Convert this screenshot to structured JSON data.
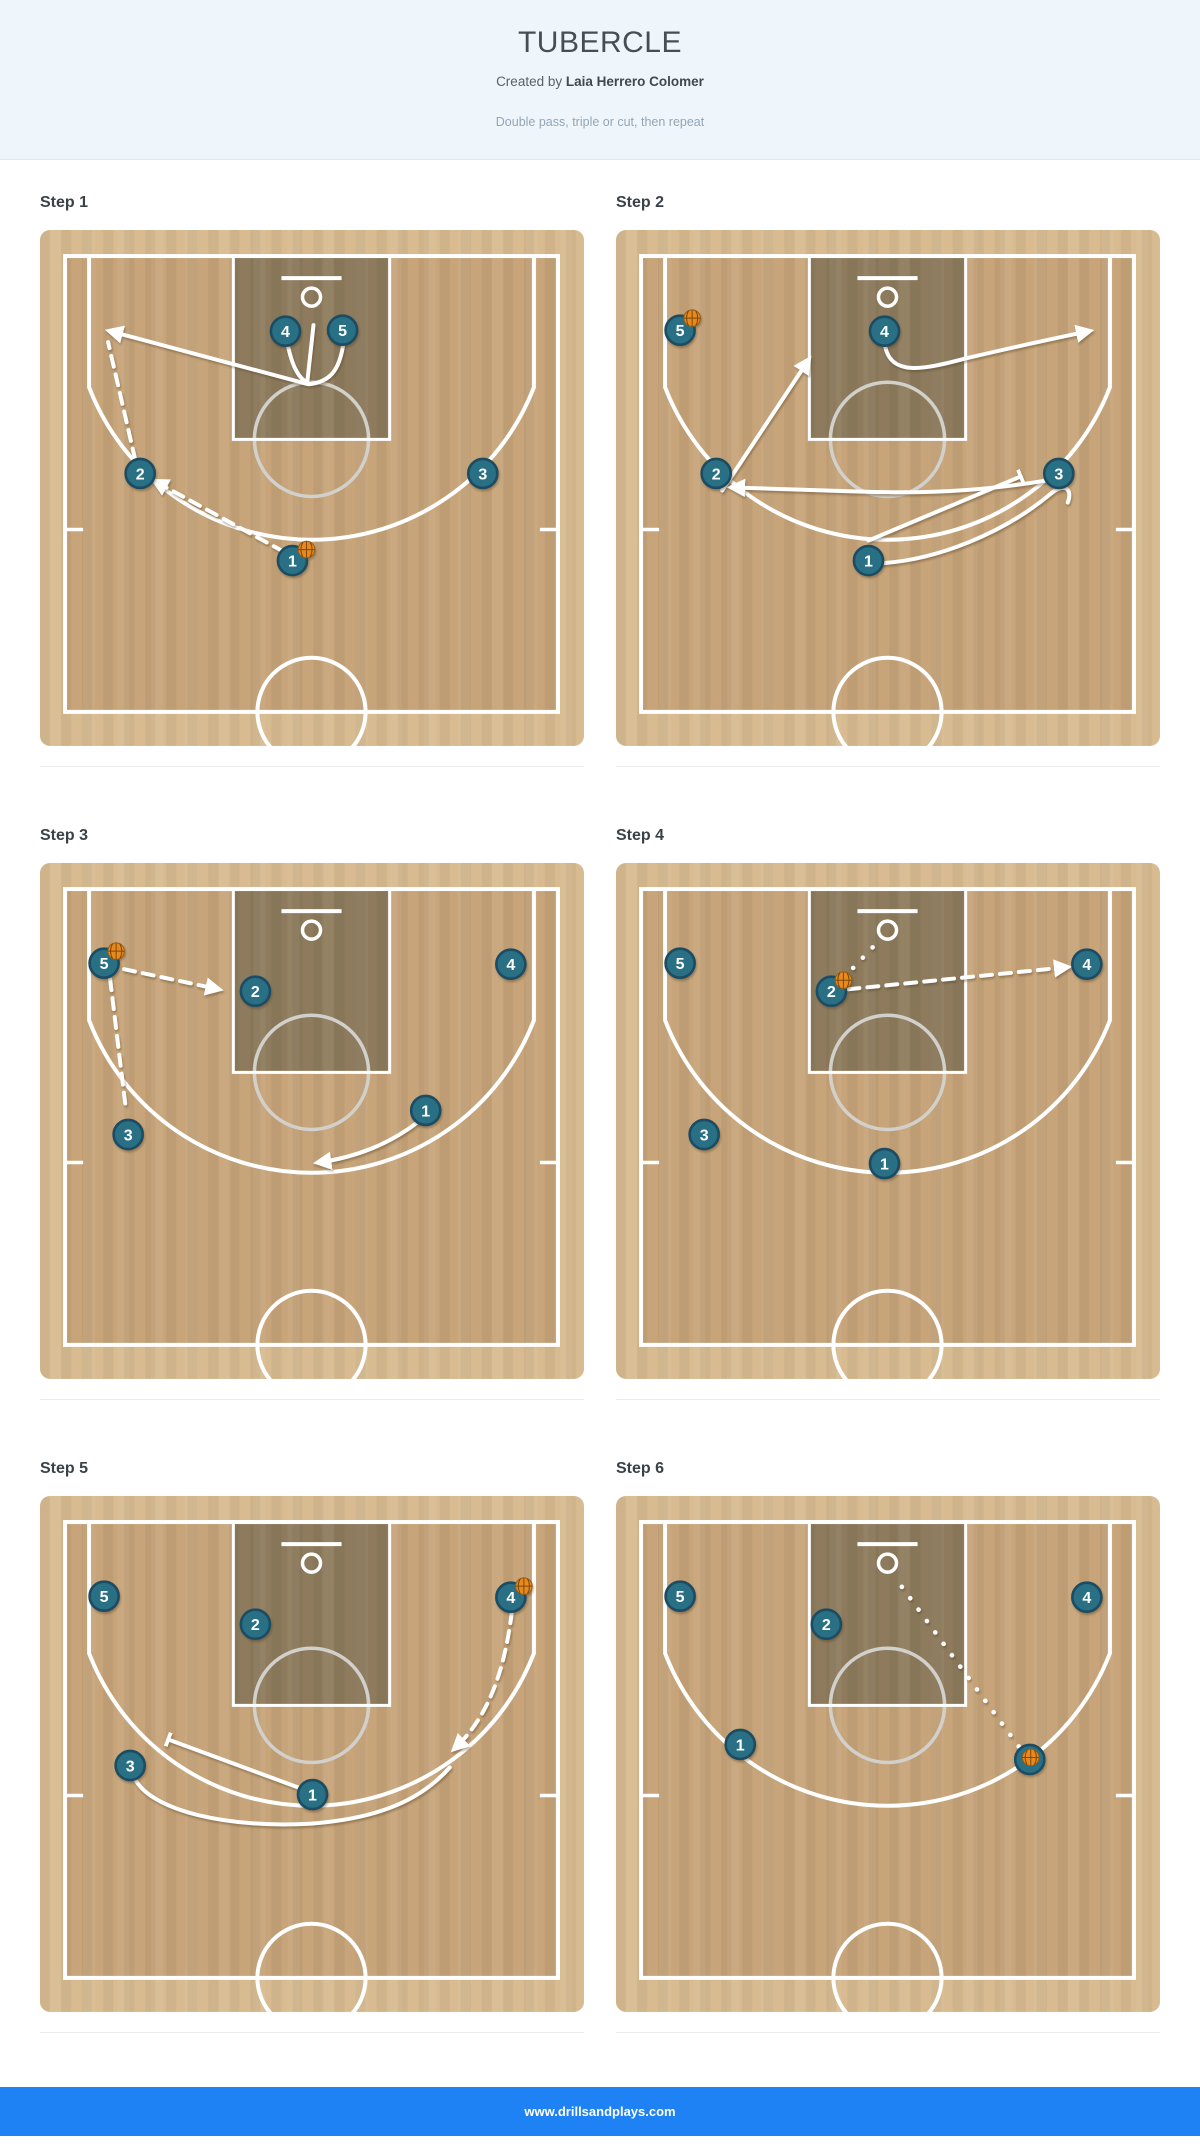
{
  "header": {
    "title": "TUBERCLE",
    "created_by_prefix": "Created by",
    "author": "Laia Herrero Colomer",
    "description": "Double pass, triple or cut, then repeat"
  },
  "footer": {
    "website": "www.drillsandplays.com"
  },
  "colors": {
    "header_bg": "#eef6fb",
    "footer_bg": "#1e82f5",
    "court_border_band": "#d8bb90",
    "court_floor": "#c7a479",
    "key_fill": "#8e7b5d",
    "court_line": "#ffffff",
    "ft_circle": "#d2d0ca",
    "player_fill": "#2a7085",
    "player_border": "#1c4c63",
    "ball_fill": "#e8891d",
    "ball_seam": "#7c4a0e"
  },
  "legend": {
    "cut": "solid arrow = player movement",
    "pass": "dashed arrow = pass",
    "shot": "dotted line = shot",
    "screen": "line with bar = screen"
  },
  "steps": [
    {
      "title": "Step 1",
      "players": [
        {
          "n": "4",
          "x": 245,
          "y": 101
        },
        {
          "n": "5",
          "x": 302,
          "y": 100
        },
        {
          "n": "2",
          "x": 100,
          "y": 243
        },
        {
          "n": "3",
          "x": 442,
          "y": 243
        },
        {
          "n": "1",
          "x": 252,
          "y": 330
        }
      ],
      "ball": {
        "player": "1",
        "dx": 14,
        "dy": -11
      },
      "lines": [
        {
          "type": "move",
          "path": "M 247,113 C 252,138 259,149 268,153"
        },
        {
          "type": "move",
          "path": "M 273,95 L 267,150"
        },
        {
          "type": "cut",
          "path": "M 303,112 C 299,142 288,152 268,154 L 70,101"
        },
        {
          "type": "pass",
          "path": "M 243,321 L 115,251"
        },
        {
          "type": "dash",
          "path": "M 95,229 L 68,112"
        }
      ]
    },
    {
      "title": "Step 2",
      "players": [
        {
          "n": "5",
          "x": 64,
          "y": 100
        },
        {
          "n": "4",
          "x": 268,
          "y": 101
        },
        {
          "n": "2",
          "x": 100,
          "y": 243
        },
        {
          "n": "3",
          "x": 442,
          "y": 243
        },
        {
          "n": "1",
          "x": 252,
          "y": 330
        }
      ],
      "ball": {
        "player": "5",
        "dx": 12,
        "dy": -12
      },
      "lines": [
        {
          "type": "cut",
          "path": "M 268,112 C 272,148 308,139 350,128 C 405,115 448,106 472,101"
        },
        {
          "type": "cut",
          "path": "M 106,260 L 192,130"
        },
        {
          "type": "cut",
          "path": "M 436,249 C 360,262 300,263 240,261 L 116,257"
        },
        {
          "type": "screen",
          "path": "M 252,310 L 404,246"
        },
        {
          "type": "move",
          "path": "M 255,333 C 320,332 390,300 433,264 C 448,251 456,259 451,272"
        }
      ]
    },
    {
      "title": "Step 3",
      "players": [
        {
          "n": "5",
          "x": 64,
          "y": 100
        },
        {
          "n": "2",
          "x": 215,
          "y": 128
        },
        {
          "n": "4",
          "x": 470,
          "y": 101
        },
        {
          "n": "3",
          "x": 88,
          "y": 271
        },
        {
          "n": "1",
          "x": 385,
          "y": 247
        }
      ],
      "ball": {
        "player": "5",
        "dx": 12,
        "dy": -12
      },
      "lines": [
        {
          "type": "pass",
          "path": "M 84,106 L 178,126"
        },
        {
          "type": "dash",
          "path": "M 70,116 L 86,248"
        },
        {
          "type": "cut",
          "path": "M 378,258 C 350,280 315,294 278,299"
        }
      ]
    },
    {
      "title": "Step 4",
      "players": [
        {
          "n": "5",
          "x": 64,
          "y": 100
        },
        {
          "n": "2",
          "x": 215,
          "y": 128
        },
        {
          "n": "4",
          "x": 470,
          "y": 101
        },
        {
          "n": "3",
          "x": 88,
          "y": 271
        },
        {
          "n": "1",
          "x": 268,
          "y": 300
        }
      ],
      "ball": {
        "player": "2",
        "dx": 12,
        "dy": -11
      },
      "lines": [
        {
          "type": "shot",
          "path": "M 227,115 L 263,77"
        },
        {
          "type": "pass",
          "path": "M 232,126 L 450,104"
        }
      ]
    },
    {
      "title": "Step 5",
      "players": [
        {
          "n": "5",
          "x": 64,
          "y": 100
        },
        {
          "n": "2",
          "x": 215,
          "y": 128
        },
        {
          "n": "4",
          "x": 470,
          "y": 101
        },
        {
          "n": "3",
          "x": 90,
          "y": 269
        },
        {
          "n": "1",
          "x": 272,
          "y": 298
        }
      ],
      "ball": {
        "player": "4",
        "dx": 13,
        "dy": -11
      },
      "lines": [
        {
          "type": "pass",
          "path": "M 471,116 C 464,170 450,218 414,252"
        },
        {
          "type": "screen",
          "path": "M 266,294 L 128,243"
        },
        {
          "type": "move",
          "path": "M 94,281 C 110,315 190,332 271,327 C 348,321 385,298 409,271"
        }
      ]
    },
    {
      "title": "Step 6",
      "players": [
        {
          "n": "5",
          "x": 64,
          "y": 100
        },
        {
          "n": "2",
          "x": 210,
          "y": 128
        },
        {
          "n": "4",
          "x": 470,
          "y": 101
        },
        {
          "n": "1",
          "x": 124,
          "y": 248
        },
        {
          "n": "3",
          "x": 413,
          "y": 263
        }
      ],
      "ball": {
        "player": "3",
        "dx": 1,
        "dy": -2
      },
      "lines": [
        {
          "type": "shot",
          "path": "M 402,250 L 279,82"
        }
      ]
    }
  ]
}
